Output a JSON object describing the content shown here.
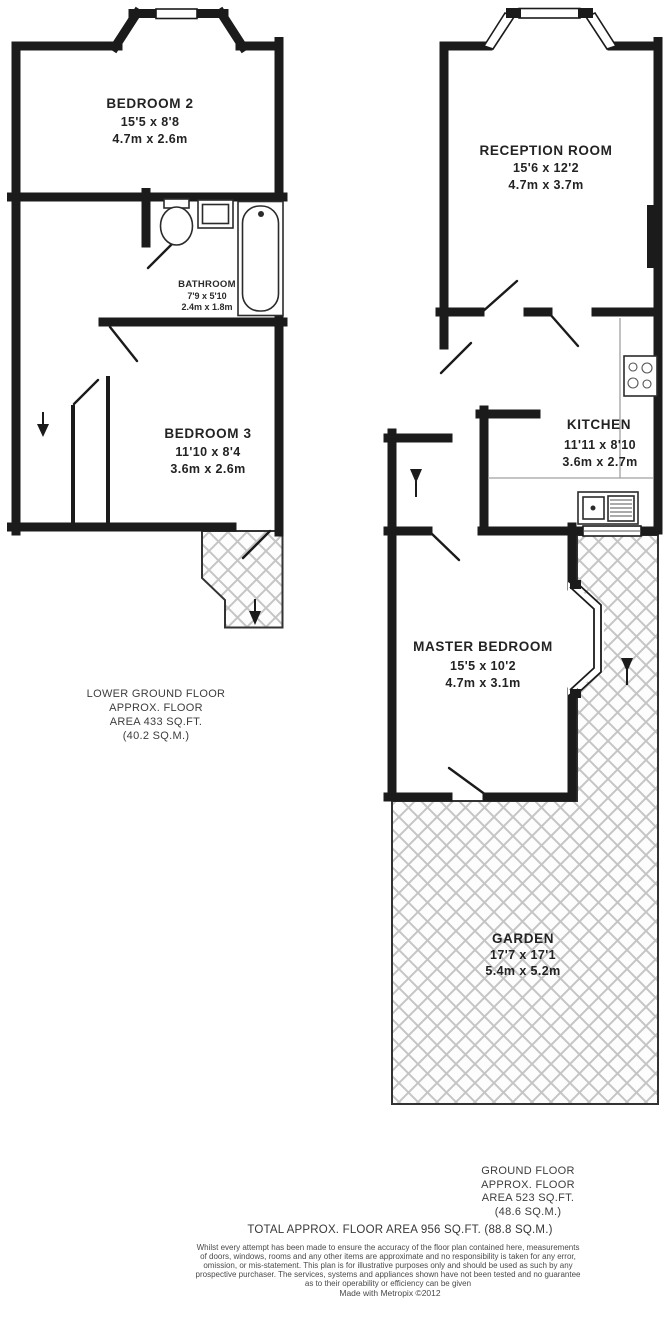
{
  "floors": {
    "lower": {
      "caption": [
        "LOWER GROUND FLOOR",
        "APPROX. FLOOR",
        "AREA 433 SQ.FT.",
        "(40.2 SQ.M.)"
      ],
      "rooms": {
        "bedroom2": {
          "name": "BEDROOM 2",
          "imperial": "15'5 x 8'8",
          "metric": "4.7m x 2.6m"
        },
        "bathroom": {
          "name": "BATHROOM",
          "imperial": "7'9 x 5'10",
          "metric": "2.4m x 1.8m"
        },
        "bedroom3": {
          "name": "BEDROOM 3",
          "imperial": "11'10 x 8'4",
          "metric": "3.6m x 2.6m"
        }
      }
    },
    "ground": {
      "caption": [
        "GROUND FLOOR",
        "APPROX. FLOOR",
        "AREA 523 SQ.FT.",
        "(48.6 SQ.M.)"
      ],
      "rooms": {
        "reception": {
          "name": "RECEPTION ROOM",
          "imperial": "15'6 x 12'2",
          "metric": "4.7m x 3.7m"
        },
        "kitchen": {
          "name": "KITCHEN",
          "imperial": "11'11 x 8'10",
          "metric": "3.6m x 2.7m"
        },
        "master": {
          "name": "MASTER BEDROOM",
          "imperial": "15'5 x 10'2",
          "metric": "4.7m x 3.1m"
        },
        "garden": {
          "name": "GARDEN",
          "imperial": "17'7 x 17'1",
          "metric": "5.4m x 5.2m"
        }
      }
    }
  },
  "summary": {
    "total": "TOTAL APPROX. FLOOR AREA 956 SQ.FT. (88.8 SQ.M.)"
  },
  "disclaimer": {
    "lines": [
      "Whilst every attempt has been made to ensure the accuracy of the floor plan contained here, measurements",
      "of doors, windows, rooms and any other items are approximate and no responsibility is taken for any error,",
      "omission, or mis-statement. This plan is for illustrative purposes only and should be used as such by any",
      "prospective purchaser. The services, systems and appliances shown have not been tested and no guarantee",
      "as to their operability or efficiency can be given"
    ],
    "credit": "Made with Metropix ©2012"
  },
  "colors": {
    "wall": "#1b1b1b",
    "label_text": "#232323",
    "caption_text": "#3d3d3d",
    "hatch_line": "#c5c5c5",
    "background": "#ffffff"
  }
}
